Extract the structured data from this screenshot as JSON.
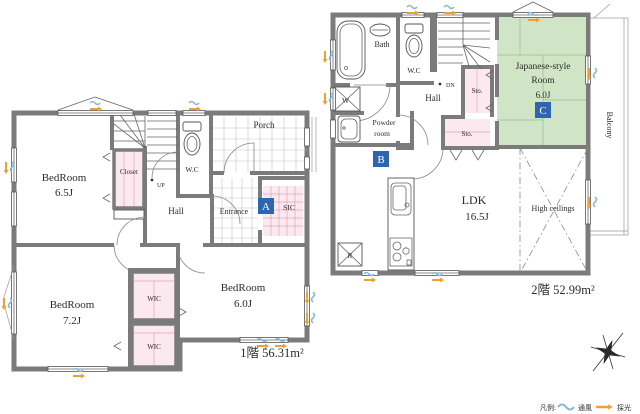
{
  "title": "2-story house floor plan",
  "floor1": {
    "area_label": "1階 56.31m²",
    "bedroom1": {
      "name": "BedRoom",
      "size": "6.5J"
    },
    "bedroom2": {
      "name": "BedRoom",
      "size": "7.2J"
    },
    "bedroom3": {
      "name": "BedRoom",
      "size": "6.0J"
    },
    "closet": "Closet",
    "wc": "W.C",
    "hall": "Hall",
    "entrance": "Entrance",
    "sic": "SIC",
    "porch": "Porch",
    "up": "UP",
    "wic_top": "WIC",
    "wic_bottom": "WIC",
    "marker_a": "A"
  },
  "floor2": {
    "area_label": "2階 52.99m²",
    "bath": "Bath",
    "wc": "W.C",
    "hall": "Hall",
    "dn": "DN",
    "sto_top": "Sto.",
    "sto_mid": "Sto.",
    "japanese_room": {
      "line1": "Japanese-style",
      "line2": "Room",
      "size": "6.0J"
    },
    "balcony": "Balcony",
    "washer": "W",
    "powder": {
      "line1": "Powder",
      "line2": "room"
    },
    "ldk": {
      "name": "LDK",
      "size": "16.5J"
    },
    "high_ceilings": "High ceilings",
    "fridge": "R",
    "marker_b": "B",
    "marker_c": "C"
  },
  "legend": {
    "title": "凡例:",
    "wind": "通風",
    "light": "採光"
  },
  "colors": {
    "wall_gray": "#7b7b7b",
    "storage_pink": "#fce8ef",
    "tatami_green": "#cfe5c6",
    "marker_blue": "#2d66ae",
    "light_orange": "#f0a030",
    "wind_blue": "#88b8d8"
  }
}
